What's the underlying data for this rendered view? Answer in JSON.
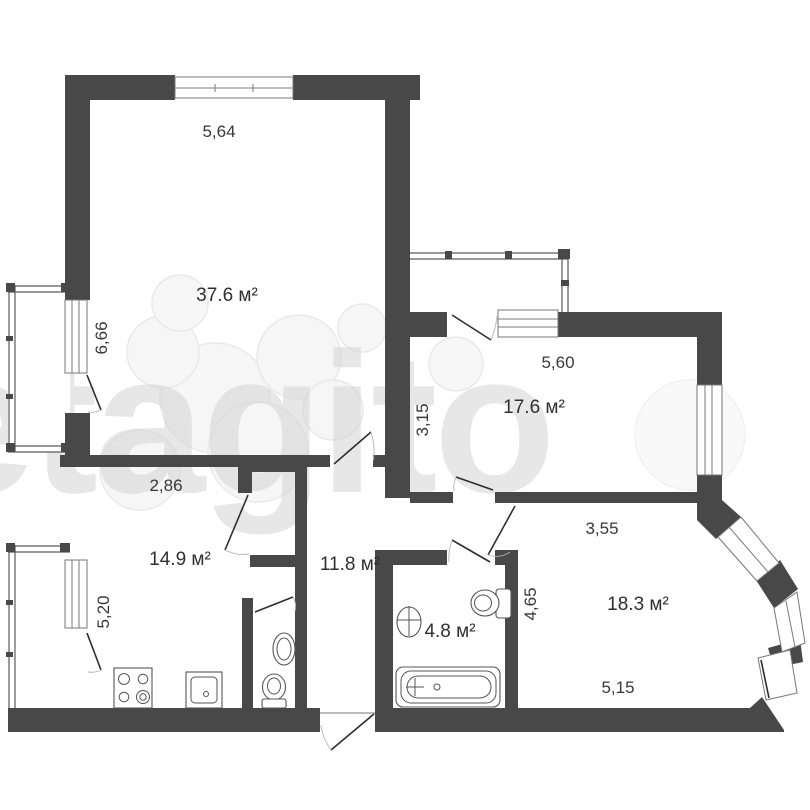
{
  "watermark": {
    "text": "etagito",
    "color": "#d4d4d4"
  },
  "palette": {
    "wall": "#484848",
    "window_line": "#7a7a7a",
    "label": "#383838"
  },
  "rooms": {
    "living": {
      "area": "37.6 м²",
      "dim_top": "5,64",
      "dim_left": "6,66"
    },
    "bedroom": {
      "area": "17.6 м²",
      "dim_top": "5,60",
      "dim_left": "3,15"
    },
    "kitchen": {
      "area": "14.9 м²",
      "dim_top": "2,86",
      "dim_left": "5,20"
    },
    "hall": {
      "area": "11.8 м²"
    },
    "bathroom": {
      "area": "4.8 м²"
    },
    "bedroom2": {
      "area": "18.3 м²",
      "dim_top": "3,55",
      "dim_left": "4,65",
      "dim_bottom": "5,15"
    }
  }
}
